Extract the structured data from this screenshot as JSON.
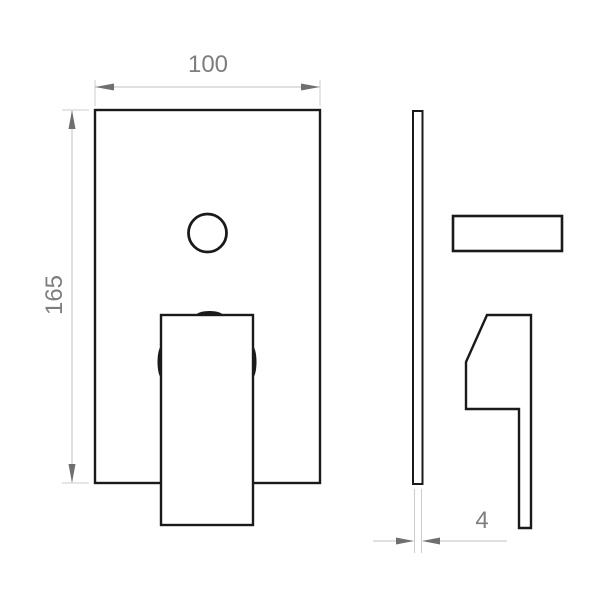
{
  "drawing": {
    "type": "technical-dimension-drawing",
    "dimensions": {
      "width": "100",
      "height": "165",
      "thickness": "4"
    },
    "colors": {
      "outline": "#1a1a1a",
      "dimension_line": "#c2c2c2",
      "arrow": "#6f6f6f",
      "text": "#7e7e7e",
      "background": "#ffffff"
    }
  }
}
